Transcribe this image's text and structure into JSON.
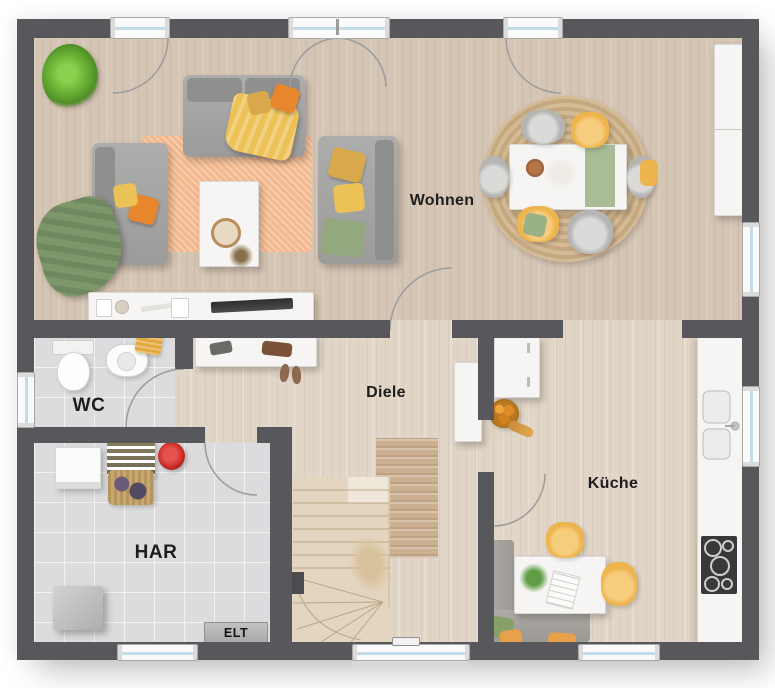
{
  "plan_title": "ground-floor-plan",
  "rooms": {
    "wohnen": {
      "label": "Wohnen"
    },
    "diele": {
      "label": "Diele"
    },
    "kueche": {
      "label": "Küche"
    },
    "wc": {
      "label": "WC"
    },
    "har": {
      "label": "HAR"
    },
    "elt": {
      "label": "ELT"
    }
  },
  "colors": {
    "wall": "#58585c",
    "wood_living": "#d5c5b4",
    "wood_hall": "#e0d5c6",
    "tile": "#dcdcde",
    "window_glass": "#c2dcea",
    "rug_living": "#f3b88d",
    "rug_dining": "#cdb28f",
    "sofa_gray": "#a3a3a1",
    "accent_orange": "#e8862d",
    "accent_yellow": "#ecc257",
    "accent_green": "#7d976b",
    "chair_yellow": "#f0b954",
    "stair_wood": "#e3d5bf",
    "red_item": "#cf2f2a",
    "cooktop": "#39393b"
  },
  "furniture": {
    "wohnen": [
      "potted-plant",
      "sofa",
      "chaise-sofa",
      "armchair",
      "area-rug",
      "coffee-table",
      "tv-sideboard",
      "dining-rug",
      "dining-table",
      "dining-chairs",
      "wall-sideboard"
    ],
    "diele": [
      "entry-shelf",
      "tall-cabinet",
      "runner-rug",
      "staircase",
      "dried-plant"
    ],
    "kueche": [
      "fridge",
      "fruit-bowl",
      "counter-with-sink",
      "cooktop",
      "kitchen-table",
      "corner-bench",
      "chairs"
    ],
    "wc": [
      "toilet",
      "sink",
      "towel"
    ],
    "har": [
      "washing-machine",
      "drying-rack",
      "laundry-basket",
      "bucket",
      "freezer",
      "elt-panel"
    ]
  },
  "openings": {
    "windows_top": 3,
    "windows_right": 2,
    "windows_left": 1,
    "windows_bottom": 2,
    "entry_door_side": "bottom"
  }
}
